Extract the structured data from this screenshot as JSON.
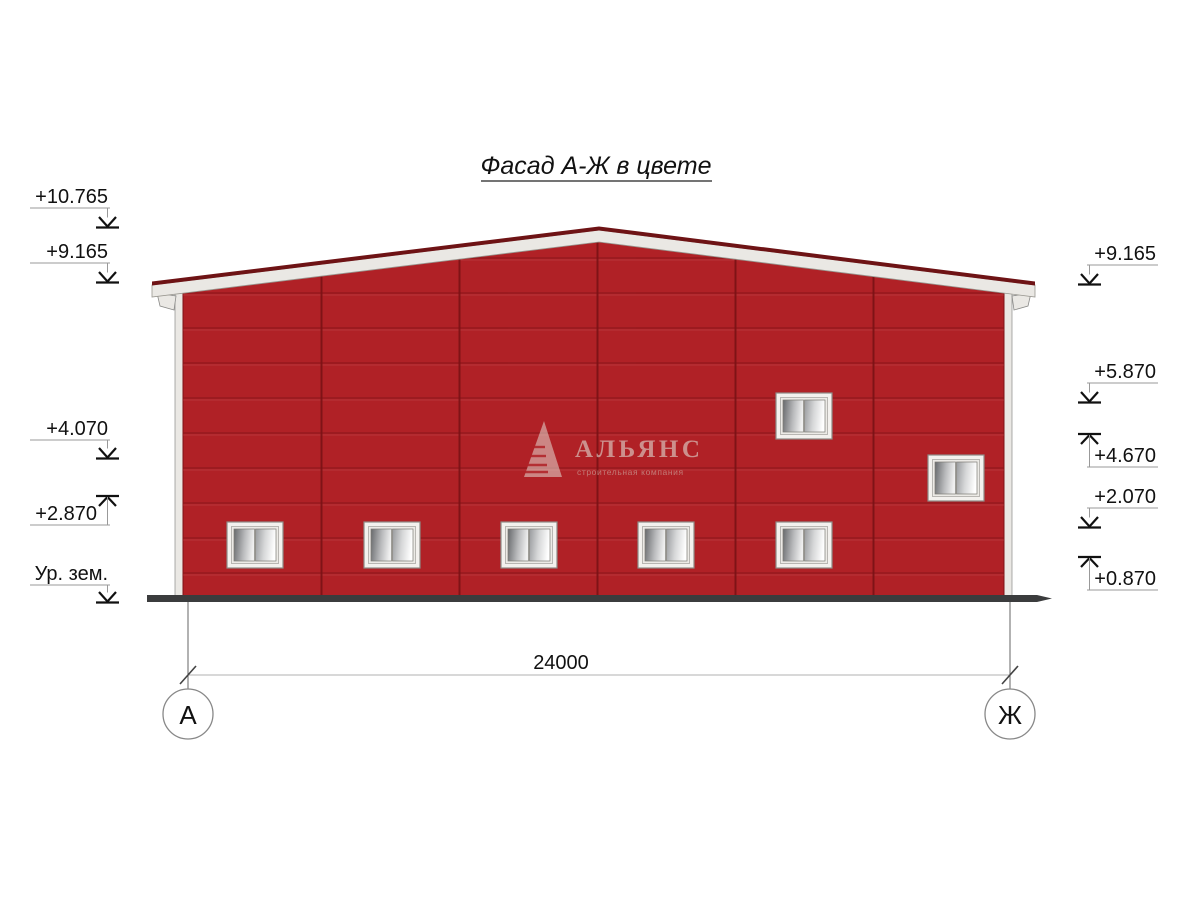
{
  "title": "Фасад А-Ж в цвете",
  "dimension": {
    "total_width": "24000"
  },
  "axes": {
    "left": "А",
    "right": "Ж"
  },
  "elevation_marks_left": [
    {
      "label": "+10.765",
      "direction": "down"
    },
    {
      "label": "+9.165",
      "direction": "down"
    },
    {
      "label": "+4.070",
      "direction": "down"
    },
    {
      "label": "+2.870",
      "direction": "up"
    },
    {
      "label": "Ур. зем.",
      "direction": "down"
    }
  ],
  "elevation_marks_right": [
    {
      "label": "+9.165",
      "direction": "down"
    },
    {
      "label": "+5.870",
      "direction": "down"
    },
    {
      "label": "+4.670",
      "direction": "up"
    },
    {
      "label": "+2.070",
      "direction": "down"
    },
    {
      "label": "+0.870",
      "direction": "up"
    }
  ],
  "watermark": {
    "name": "АЛЬЯНС",
    "subtitle": "строительная компания"
  },
  "colors": {
    "wall_red": "#b02126",
    "panel_joint": "#8a161b",
    "roof_edge": "#6e1315",
    "fascia": "#eae8e4",
    "ground": "#3b3c3d"
  }
}
